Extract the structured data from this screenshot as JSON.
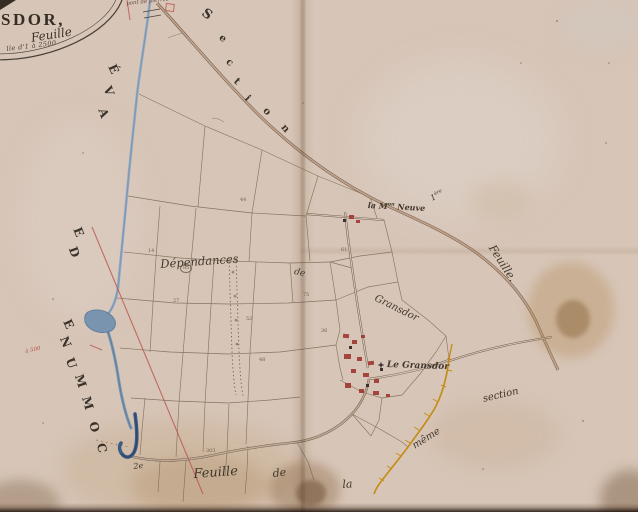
{
  "cartouche": {
    "name": "SDOR,",
    "subtitle": "Feuille",
    "scale": "lle d'1 à 2500"
  },
  "labels": {
    "bridge": "pont de pierres",
    "maison_pre": "la M",
    "maison_sup": "on",
    "maison_post": "Neuve",
    "premiere_pre": "1",
    "premiere_sup": "ère",
    "feuille_right": "Feuille.",
    "dependances": "Dépendances",
    "de_mid": "de",
    "gransdor": "Gransdor",
    "le_gransdor": "Le Gransdor",
    "section_right": "section",
    "meme": "même",
    "deux_e": "2e",
    "feuille_bottom": "Feuille",
    "de_bottom": "de",
    "la_bottom": "la",
    "red_note": "à 500"
  },
  "spaced": {
    "section": [
      "S",
      "e",
      "c",
      "t",
      "i",
      "o",
      "n"
    ],
    "commune": [
      "C",
      "O",
      "M",
      "M",
      "U",
      "N",
      "E"
    ],
    "de": [
      "D",
      "E"
    ],
    "ave": [
      "A",
      "V",
      "É"
    ]
  },
  "parcels": [
    "85",
    "52",
    "75",
    "36",
    "48",
    "27",
    "14",
    "61",
    "44",
    "303"
  ],
  "colors": {
    "paper": "#d7c5b7",
    "ink": "#3f372e",
    "stream": "#7f9ab6",
    "stream_dark": "#3e5c85",
    "survey_red": "#bb5a52",
    "boundary_ochre": "#c68a12",
    "buildings_red": "#a03a32"
  }
}
